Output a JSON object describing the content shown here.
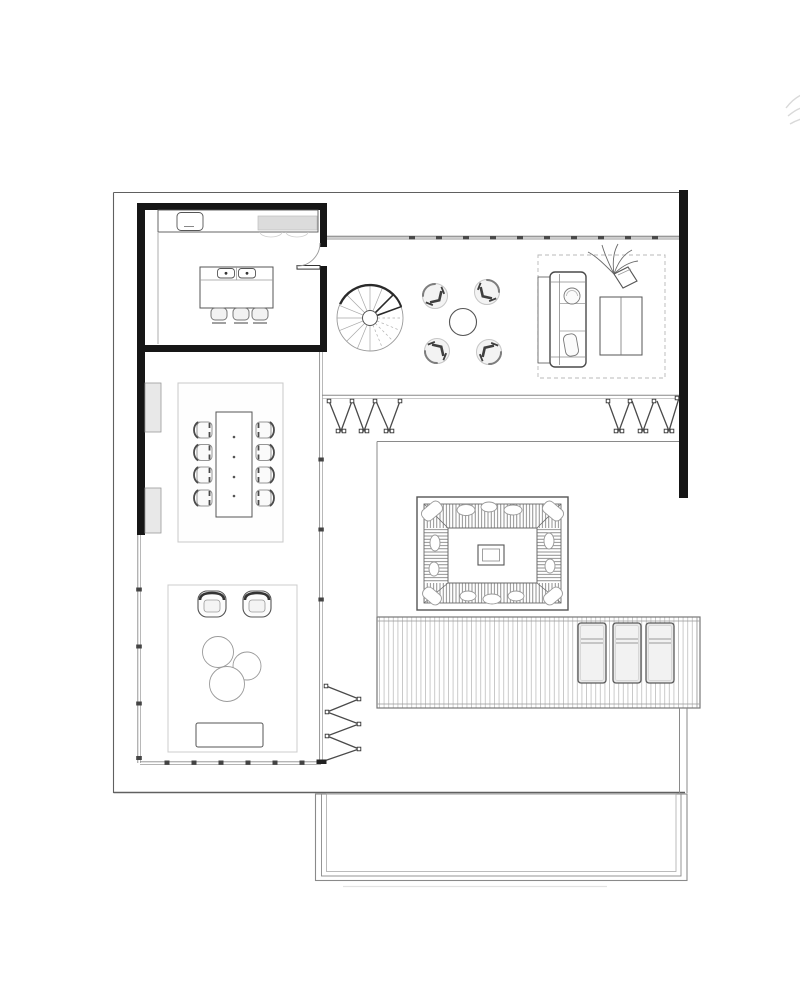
{
  "document": {
    "kind": "architectural floor plan",
    "view": "top-down single-storey house with pool terrace",
    "visible_text": "",
    "background": "#ffffff"
  },
  "palette": {
    "paper": "#ffffff",
    "structural_wall": "#161616",
    "outline": "#606060",
    "furniture_line": "#555555",
    "light_line": "#b5b5b5",
    "glass_line": "#8a8a8a",
    "appliance_fill": "#dcdcdc",
    "cabinet_fill": "#e8e8e8",
    "lounger_fill": "#e9e9e9"
  },
  "areas": [
    {
      "name": "kitchen",
      "enclosure": "thick solid walls with hinged door",
      "items": [
        "worktop counter",
        "sink",
        "gray cooktop appliance",
        "island with two hobs",
        "three bar stools"
      ]
    },
    {
      "name": "stair-hall",
      "items": [
        "spiral staircase with sixteen radial treads"
      ]
    },
    {
      "name": "conversation-corner",
      "items": [
        "four armchairs",
        "round side table"
      ]
    },
    {
      "name": "living-room",
      "items": [
        "sofa with two pillows",
        "console behind sofa",
        "two-part coffee table",
        "potted plant",
        "dashed area rug"
      ]
    },
    {
      "name": "dining-room",
      "items": [
        "rectangular table",
        "eight chairs",
        "two wall cabinets",
        "area rug",
        "four table-top dots"
      ]
    },
    {
      "name": "family-lounge",
      "items": [
        "two tub chairs",
        "three round nesting tables",
        "low bench",
        "area rug"
      ]
    },
    {
      "name": "sunken-lounge",
      "items": [
        "hatched cushion ring",
        "scatter pillows",
        "low center table"
      ]
    },
    {
      "name": "deck",
      "items": [
        "vertical timber planks",
        "three sun loungers"
      ]
    },
    {
      "name": "pool-terrace",
      "items": [
        "three nested rectangular borders"
      ]
    }
  ],
  "openings": {
    "glazed_walls": [
      "north glass wall with mullion dashes",
      "west glass wall",
      "south glass wall",
      "east glass wall"
    ],
    "folding_doors": [
      {
        "location": "north-left",
        "v_panels": 3
      },
      {
        "location": "north-right",
        "v_panels": 3
      },
      {
        "location": "south-east-vertical",
        "v_panels": 6
      }
    ],
    "hinged_doors": [
      {
        "location": "kitchen east wall",
        "swing": "quarter-circle"
      }
    ]
  },
  "counts": {
    "bar_stools": 3,
    "dining_chairs": 8,
    "armchairs": 4,
    "tub_chairs": 2,
    "nesting_tables": 3,
    "sun_loungers": 3,
    "sunken_lounge_pillows": 14,
    "spiral_stair_spokes": 16
  }
}
